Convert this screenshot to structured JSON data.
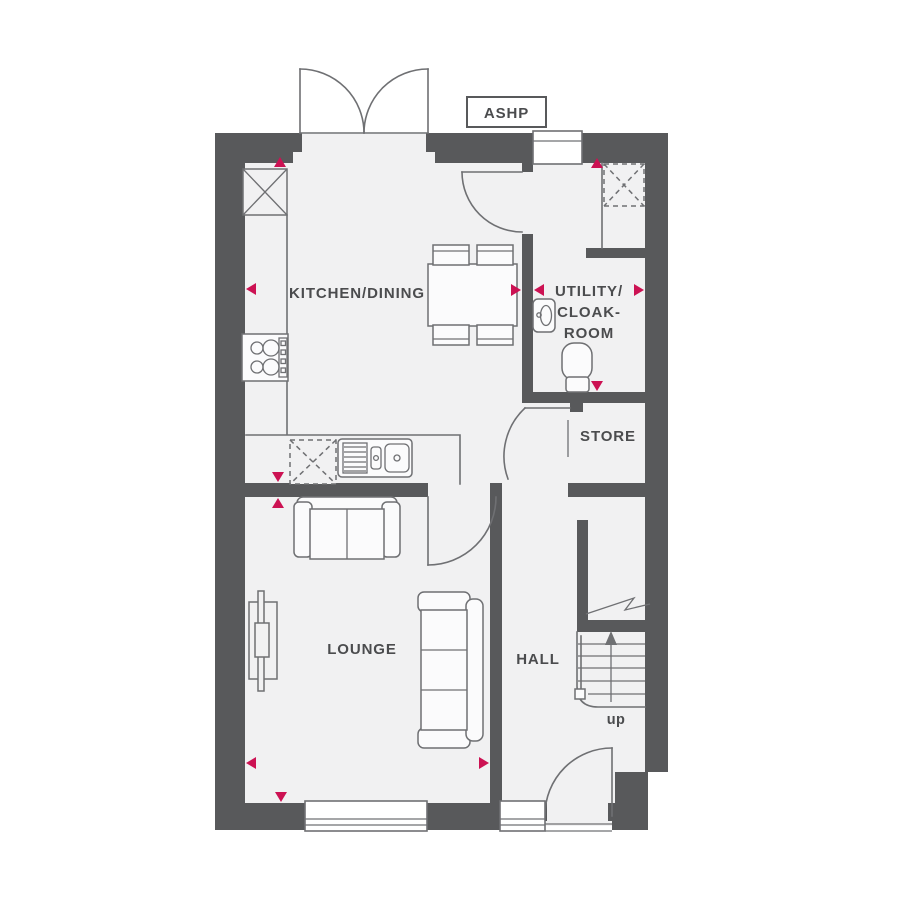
{
  "ashp_label": "ASHP",
  "rooms": {
    "kitchen_dining": "KITCHEN/DINING",
    "utility_line1": "UTILITY/",
    "utility_line2": "CLOAK-",
    "utility_line3": "ROOM",
    "store": "STORE",
    "lounge": "LOUNGE",
    "hall": "HALL"
  },
  "stairs": {
    "direction_label": "up"
  },
  "colors": {
    "wall": "#58595b",
    "line": "#6f7073",
    "floor": "#f1f1f2",
    "marker": "#cc1253",
    "text": "#4b4c4e"
  }
}
